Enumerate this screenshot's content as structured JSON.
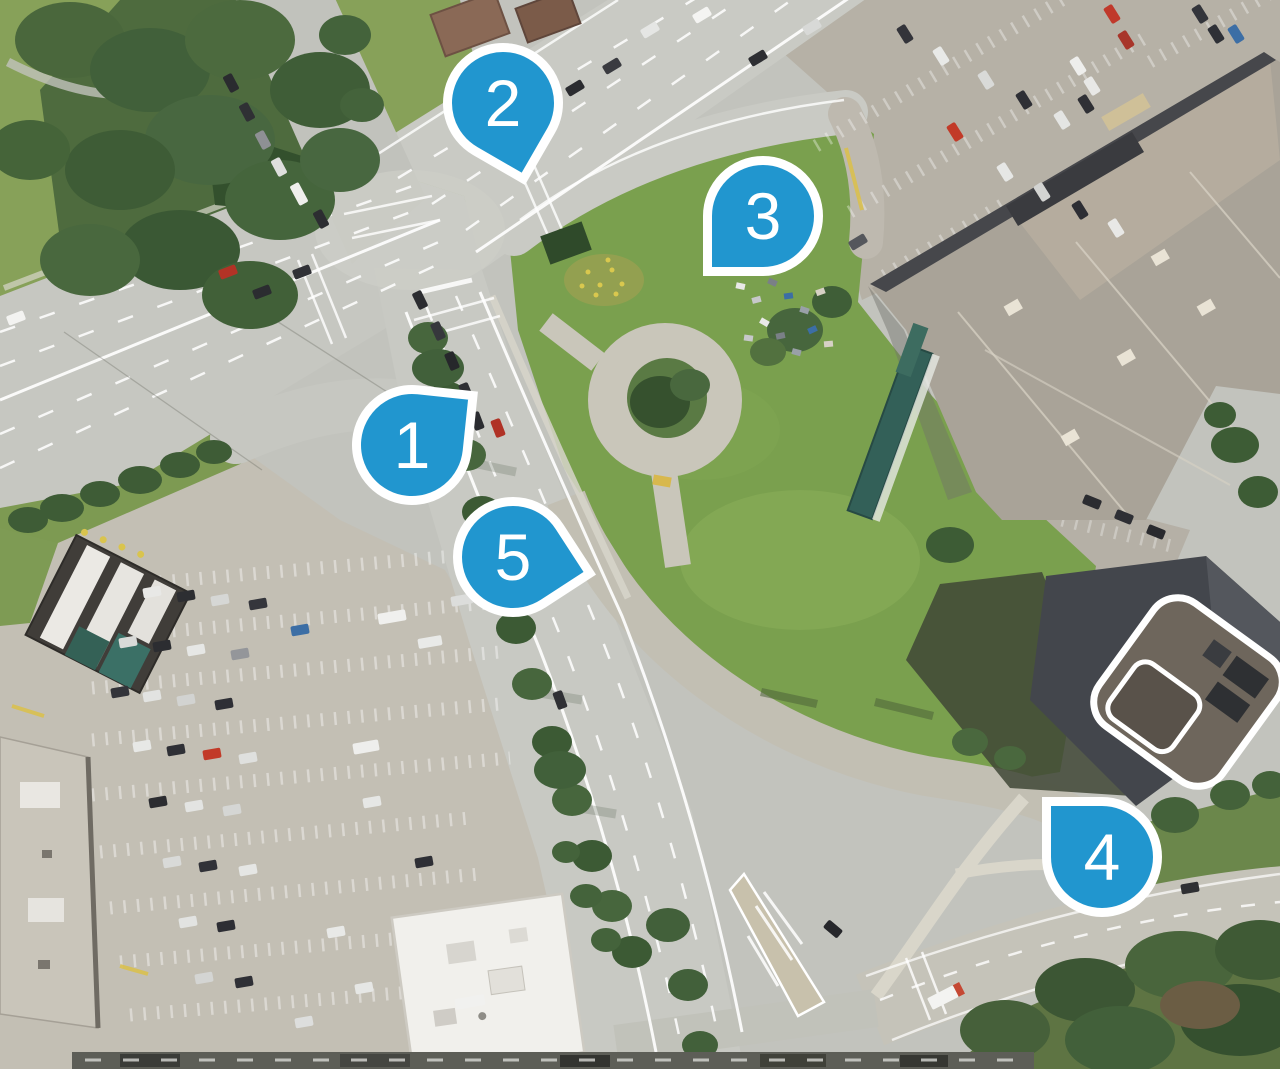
{
  "map": {
    "type": "satellite-aerial-imagery",
    "marker_color": "#2196cf",
    "marker_border_color": "#ffffff",
    "marker_label_color": "#ffffff",
    "markers": [
      {
        "label": "1",
        "x": 412,
        "y": 445,
        "rotation": -84,
        "tip": "northeast"
      },
      {
        "label": "2",
        "x": 503,
        "y": 103,
        "rotation": 30,
        "tip": "south"
      },
      {
        "label": "3",
        "x": 763,
        "y": 216,
        "rotation": 90,
        "tip": "southwest"
      },
      {
        "label": "4",
        "x": 1102,
        "y": 857,
        "rotation": 180,
        "tip": "northwest"
      },
      {
        "label": "5",
        "x": 513,
        "y": 557,
        "rotation": -33,
        "tip": "east"
      }
    ]
  }
}
